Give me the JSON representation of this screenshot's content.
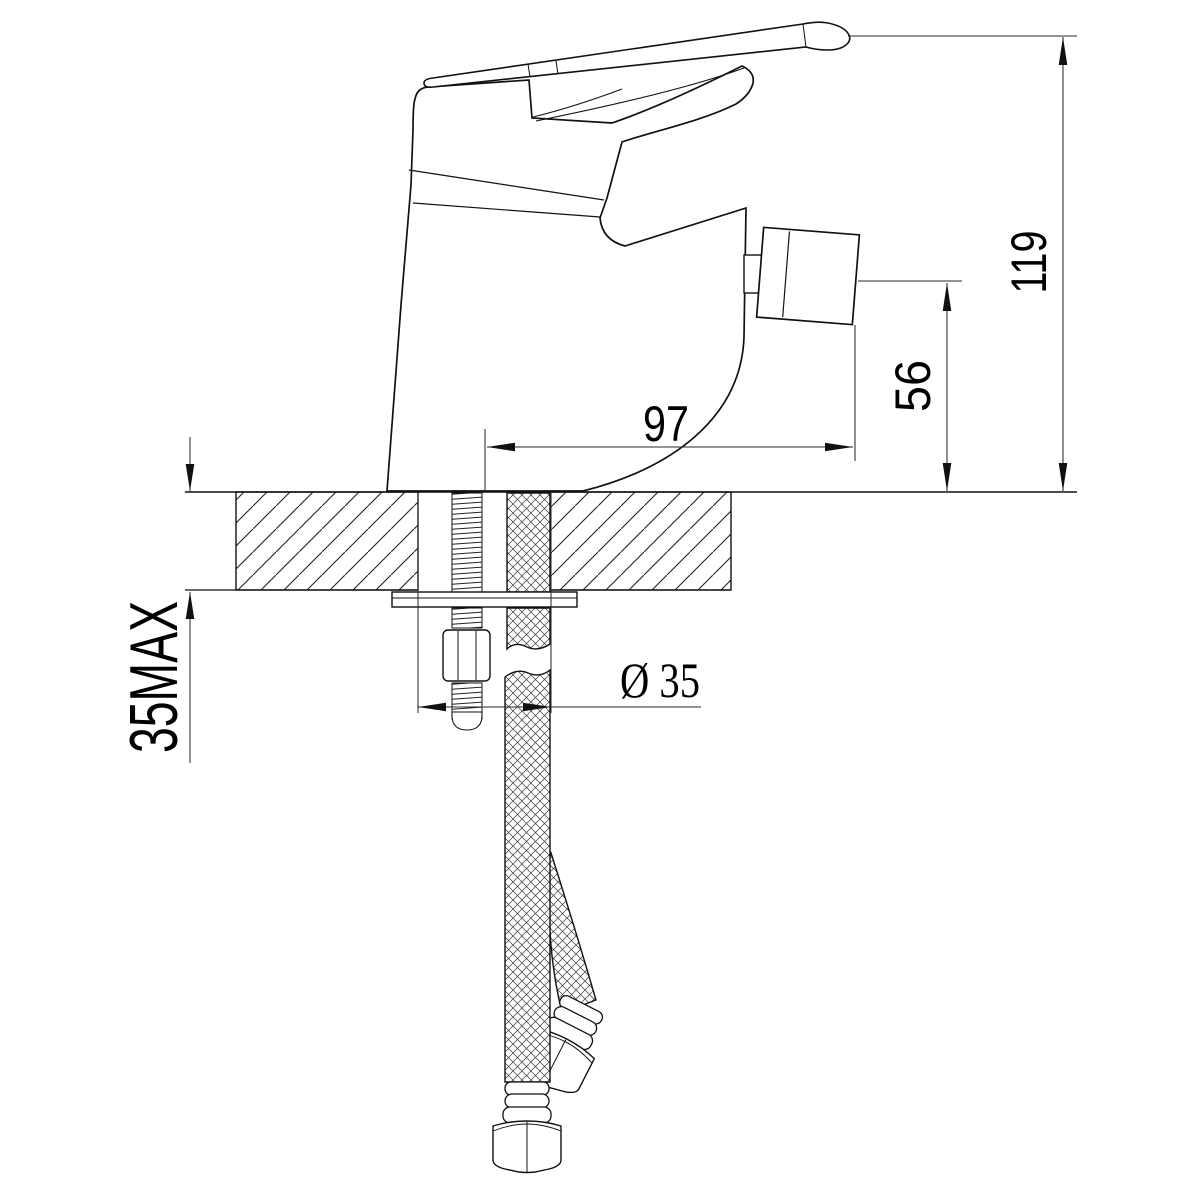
{
  "meta": {
    "background_color": "#ffffff",
    "line_color": "#111111",
    "drawing_kind": "faucet installation dimension drawing"
  },
  "dims": {
    "overall_height": "119",
    "outlet_height": "56",
    "outlet_reach": "97",
    "mounting_hole_diameter": "Ø 35",
    "max_deck_thickness": "35MAX"
  }
}
